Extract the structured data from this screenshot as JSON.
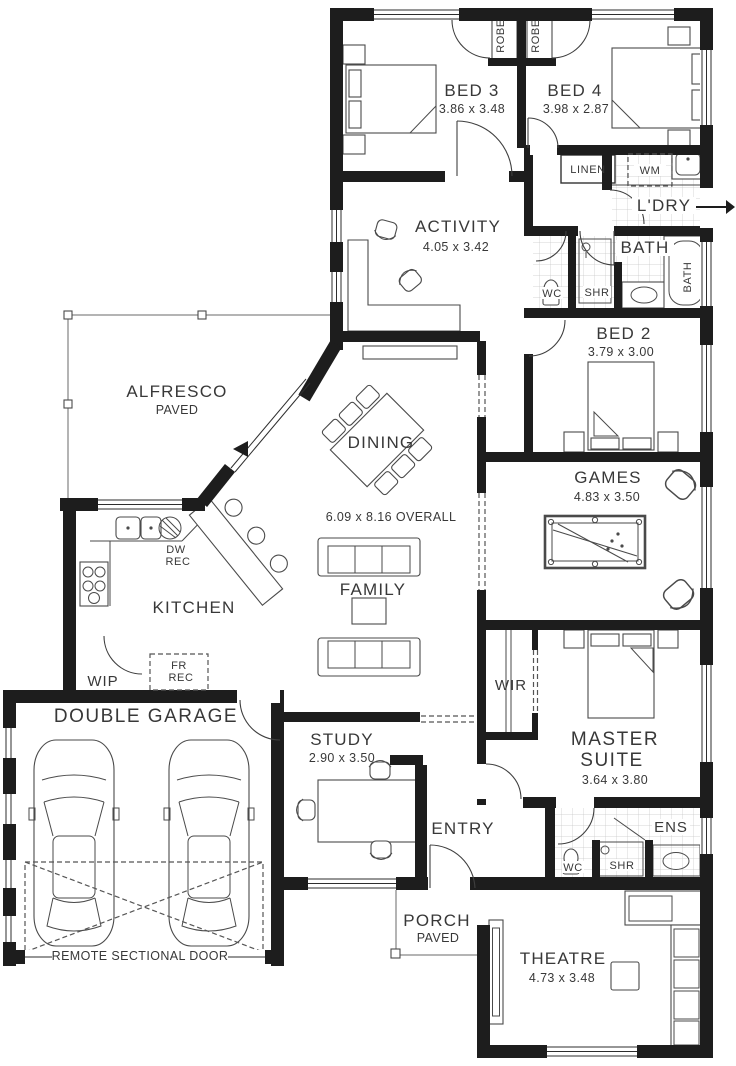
{
  "plan": {
    "colors": {
      "wall": "#1d1d1d",
      "furniture_line": "#4a4a4a",
      "tile_grid": "#c6c6c6",
      "text": "#383838"
    },
    "rooms": {
      "bed3": {
        "name": "BED 3",
        "dims": "3.86 x 3.48"
      },
      "bed4": {
        "name": "BED 4",
        "dims": "3.98 x 2.87"
      },
      "robe_bed3": {
        "name": "ROBE"
      },
      "robe_bed4": {
        "name": "ROBE"
      },
      "linen": {
        "name": "LINEN"
      },
      "laundry": {
        "name": "L'DRY",
        "wm": "WM"
      },
      "activity": {
        "name": "ACTIVITY",
        "dims": "4.05 x 3.42"
      },
      "bath": {
        "name": "BATH",
        "wc": "WC",
        "shr": "SHR",
        "tub": "BATH"
      },
      "bed2": {
        "name": "BED 2",
        "dims": "3.79 x 3.00"
      },
      "alfresco": {
        "name": "ALFRESCO",
        "sub": "PAVED"
      },
      "dining": {
        "name": "DINING"
      },
      "games": {
        "name": "GAMES",
        "dims": "4.83 x 3.50"
      },
      "kitchen": {
        "name": "KITCHEN",
        "dw_line1": "DW",
        "dw_line2": "REC",
        "fr_line1": "FR",
        "fr_line2": "REC"
      },
      "family": {
        "name": "FAMILY"
      },
      "wip": {
        "name": "WIP"
      },
      "garage": {
        "name": "DOUBLE GARAGE",
        "door_label": "REMOTE SECTIONAL DOOR"
      },
      "study": {
        "name": "STUDY",
        "dims": "2.90 x 3.50"
      },
      "wir": {
        "name": "WIR"
      },
      "master": {
        "name_line1": "MASTER",
        "name_line2": "SUITE",
        "dims": "3.64 x 3.80"
      },
      "entry": {
        "name": "ENTRY"
      },
      "ens": {
        "name": "ENS",
        "wc": "WC",
        "shr": "SHR"
      },
      "porch": {
        "name": "PORCH",
        "sub": "PAVED"
      },
      "theatre": {
        "name": "THEATRE",
        "dims": "4.73 x 3.48"
      }
    },
    "annotations": {
      "overall_dims": "6.09 x 8.16 OVERALL"
    }
  }
}
